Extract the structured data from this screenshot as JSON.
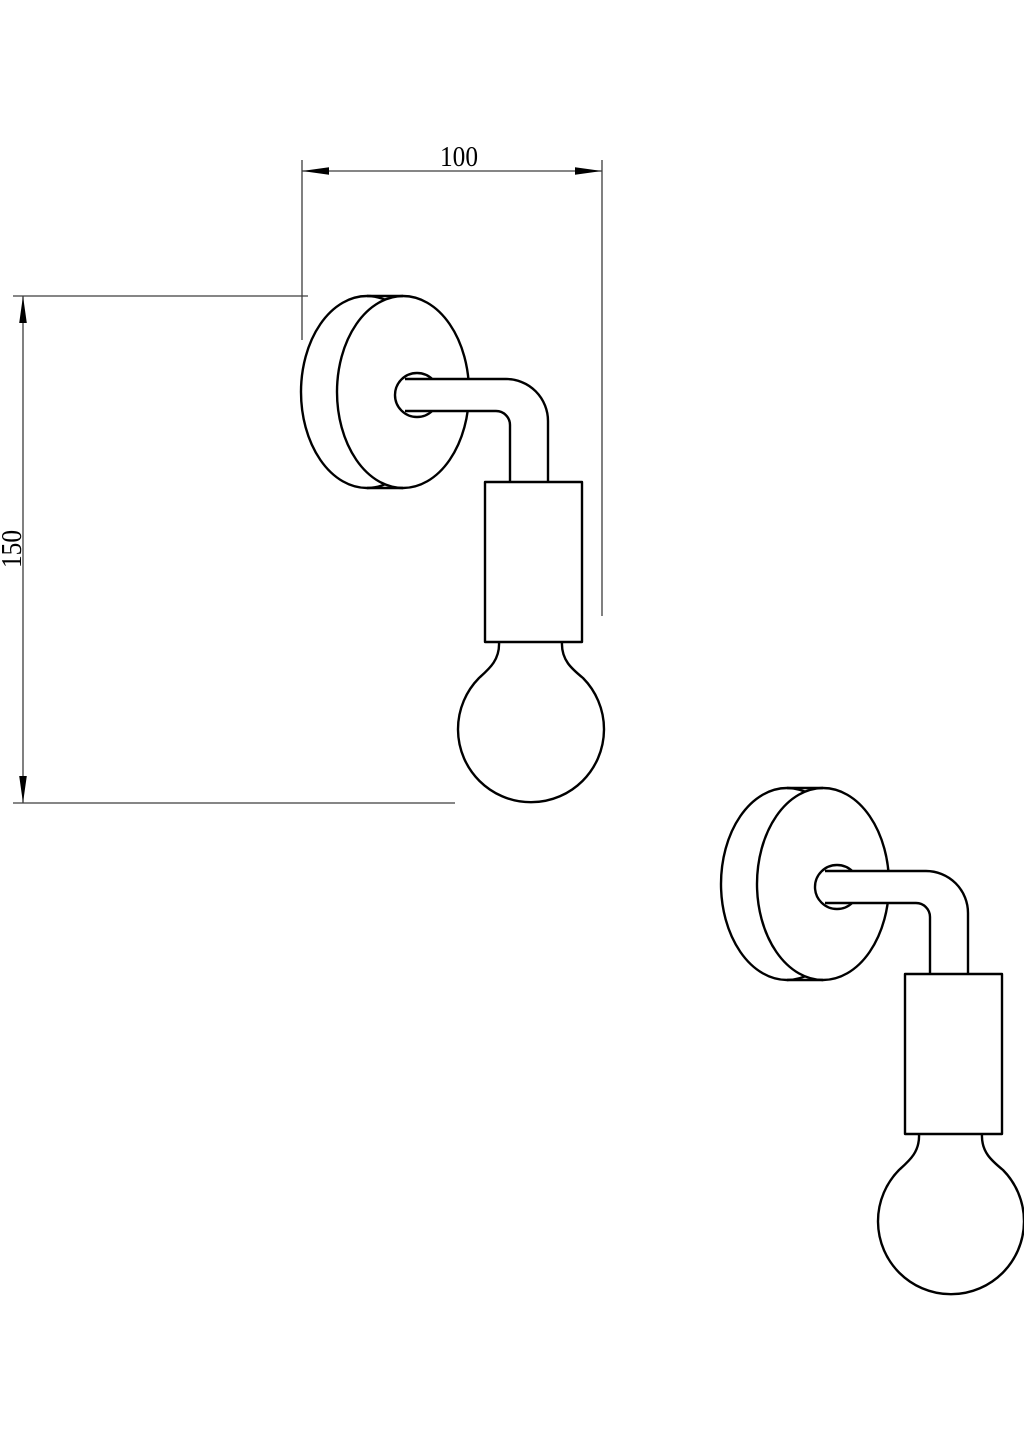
{
  "drawing": {
    "kind": "wall-sconce-technical-line-drawing",
    "background_color": "#ffffff",
    "outline_color": "#000000",
    "dimension_line_color": "#3d3d3d",
    "dimensions": {
      "width": {
        "label": "100"
      },
      "height": {
        "label": "150"
      }
    },
    "views": [
      {
        "name": "dimensioned-view"
      },
      {
        "name": "secondary-view"
      }
    ]
  }
}
